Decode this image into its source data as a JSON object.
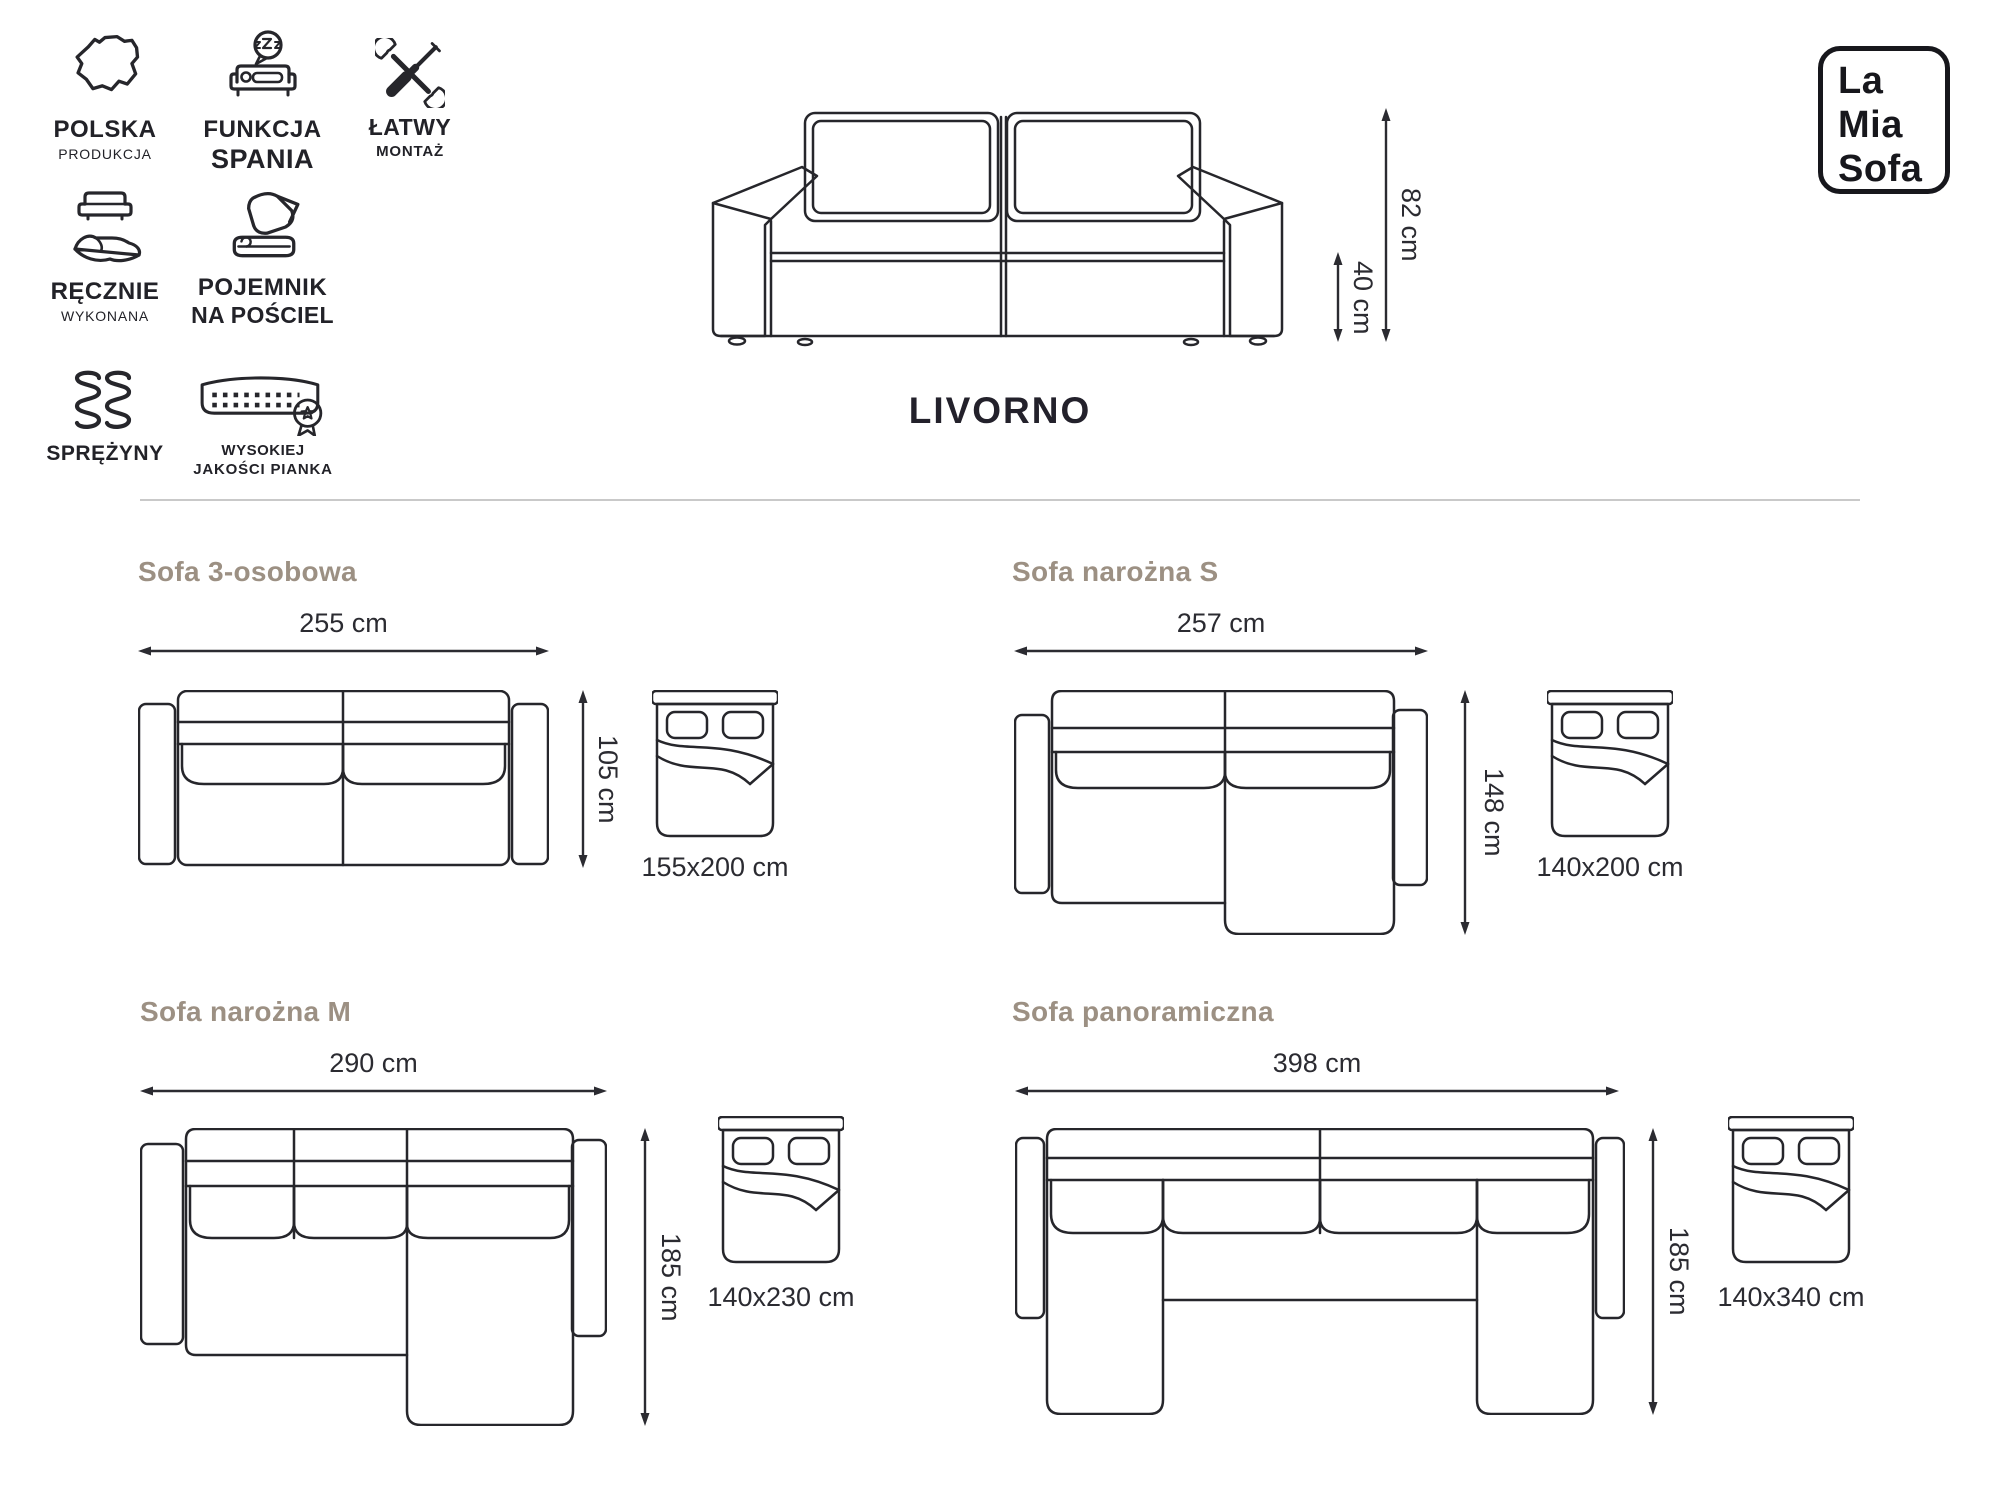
{
  "brand": {
    "l1": "La",
    "l2": "Mia",
    "l3": "Sofa"
  },
  "product": {
    "name": "LIVORNO"
  },
  "features": [
    {
      "label": "POLSKA",
      "sub": "PRODUKCJA"
    },
    {
      "label": "FUNKCJA",
      "sub": "SPANIA"
    },
    {
      "label": "ŁATWY",
      "sub": "MONTAŻ"
    },
    {
      "label": "RĘCZNIE",
      "sub": "WYKONANA"
    },
    {
      "label": "POJEMNIK",
      "sub": "NA POŚCIEL"
    },
    {
      "label": "SPRĘŻYNY",
      "sub": ""
    },
    {
      "label": "WYSOKIEJ",
      "sub": "JAKOŚCI PIANKA"
    }
  ],
  "front_view": {
    "height": "82 cm",
    "seat_height": "40 cm"
  },
  "variants": [
    {
      "name": "Sofa 3-osobowa",
      "width": "255 cm",
      "depth": "105 cm",
      "bed": "155x200 cm"
    },
    {
      "name": "Sofa narożna S",
      "width": "257 cm",
      "depth": "148 cm",
      "bed": "140x200 cm"
    },
    {
      "name": "Sofa narożna M",
      "width": "290 cm",
      "depth": "185 cm",
      "bed": "140x230 cm"
    },
    {
      "name": "Sofa panoramiczna",
      "width": "398 cm",
      "depth": "185 cm",
      "bed": "140x340 cm"
    }
  ],
  "colors": {
    "line": "#26262b",
    "accent_title": "#9c9083",
    "text": "#2b2b31",
    "divider": "#c9c9c9"
  }
}
